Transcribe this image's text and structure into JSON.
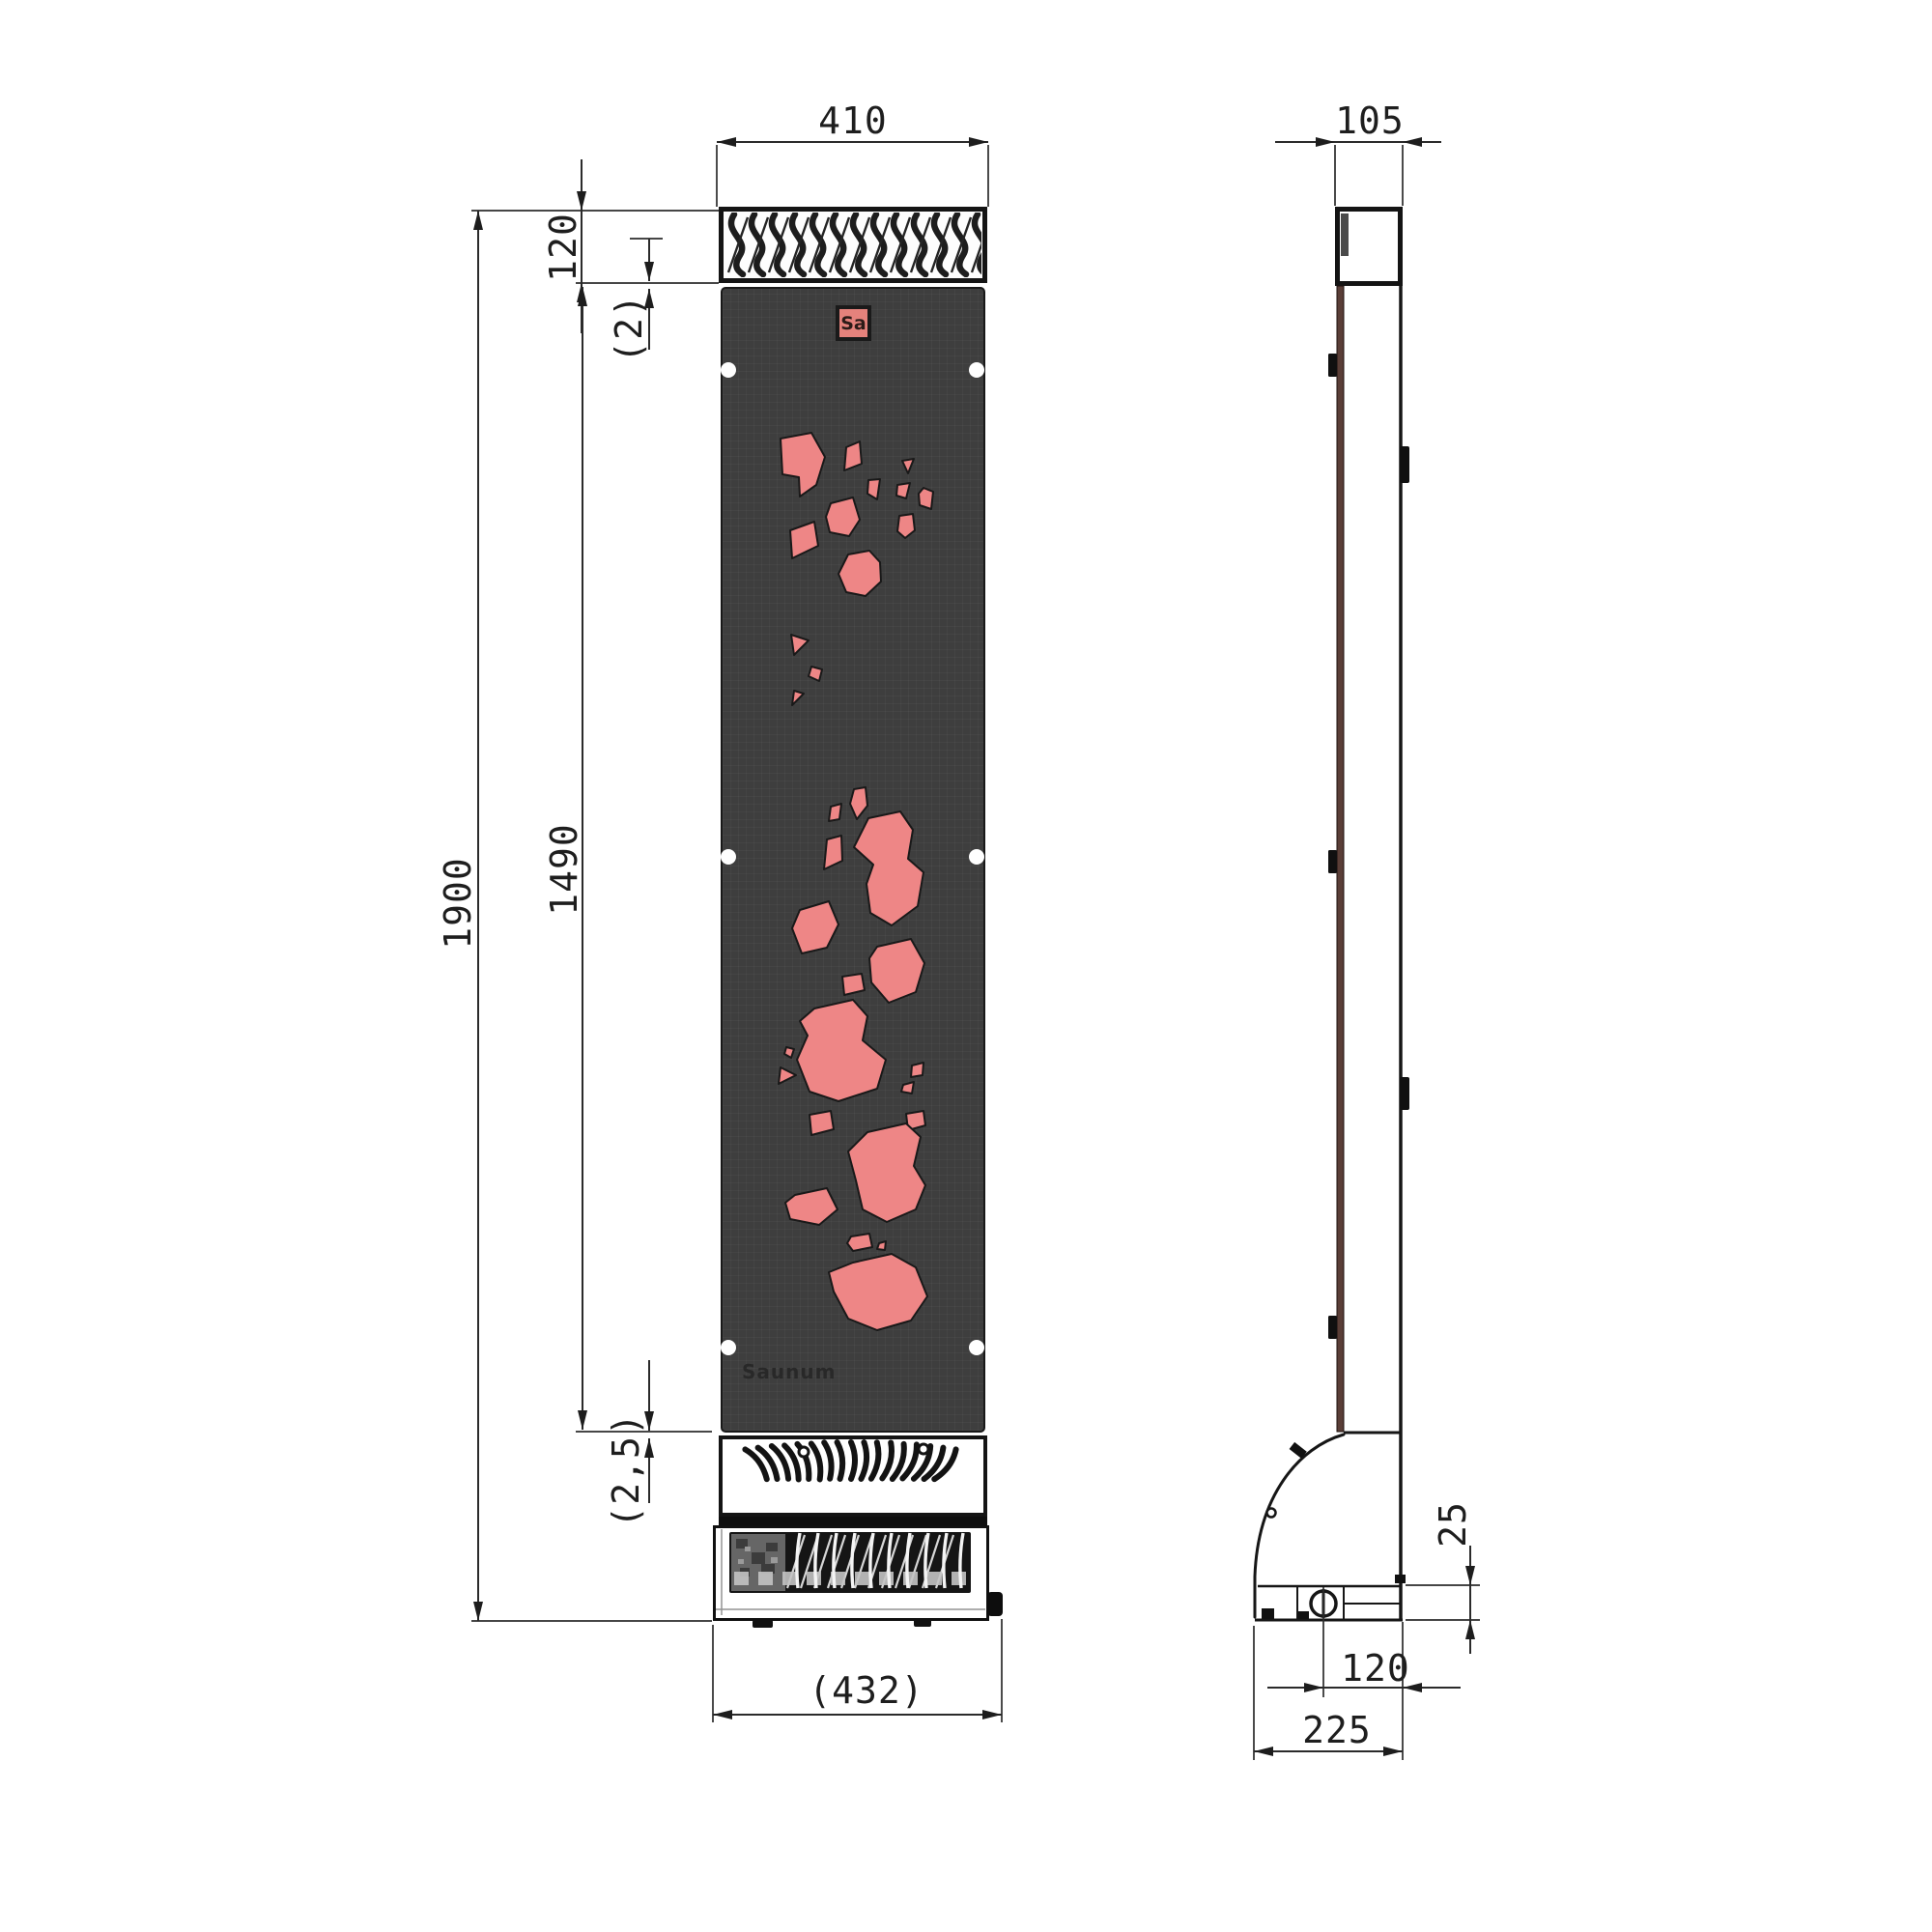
{
  "logo": {
    "badge": "Sa",
    "brand": "Saunum"
  },
  "dims": {
    "front_width": "410",
    "grille_height": "120",
    "grille_gap": "(2)",
    "total_height": "1900",
    "panel_height": "1490",
    "panel_gap": "(2,5)",
    "base_width": "(432)",
    "depth_top": "105",
    "base_height": "25",
    "knob_offset": "120",
    "depth_bottom": "225"
  },
  "colors": {
    "cutout": "#ee8686",
    "panel": "#3e3e3e",
    "badge_bg": "#e5827c",
    "side_edge": "#5a3e37",
    "line": "#1e1e1e"
  }
}
